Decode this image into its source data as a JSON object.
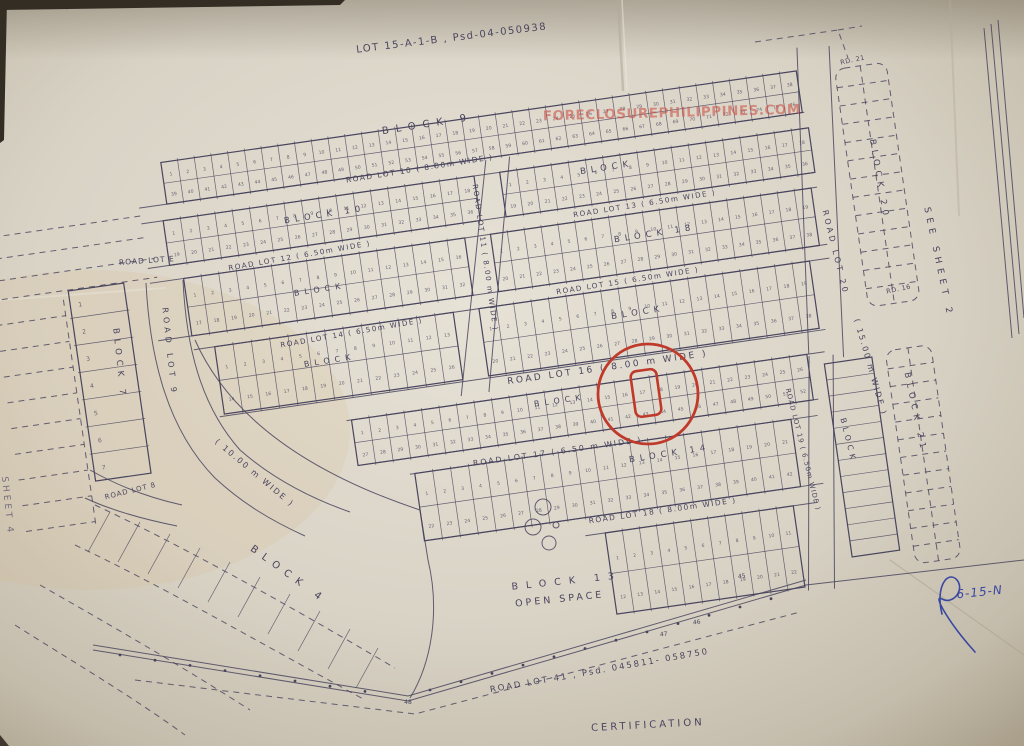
{
  "photo": {
    "description": "photographed blueprint subdivision survey plan",
    "watermark": "FORECLOSUREPHILIPPINES.COM",
    "handwritten_note": "6-15-N"
  },
  "colors": {
    "paper": "#d9d3c6",
    "paper_edge": "#8f8676",
    "ink": "#49455e",
    "highlight_red": "#bf3a2b",
    "pen_blue": "#3947a3",
    "watermark_red": "#cb5448"
  },
  "labels": [
    {
      "id": "top-contractor",
      "t": "GW / CONTRACTOR",
      "x": 112,
      "y": 6,
      "r": -4,
      "s": 8.5,
      "sp": 1,
      "c": "ink-faint"
    },
    {
      "id": "top-developer",
      "t": "DEVELOPER",
      "x": 268,
      "y": 4,
      "r": -3,
      "s": 8.5,
      "sp": 1.5,
      "c": "ink-faint"
    },
    {
      "id": "plan-title",
      "t": "LOT 15-A-1-B , Psd-04-050938",
      "x": 452,
      "y": 41,
      "r": -7,
      "s": 10,
      "sp": 1.5,
      "c": "ink"
    },
    {
      "id": "watermark",
      "t": "FORECLOSUREPHILIPPINES.COM",
      "x": 672,
      "y": 117,
      "r": -1.5,
      "s": 13.5,
      "sp": 0.5,
      "c": "wm"
    },
    {
      "id": "block-9",
      "t": "BLOCK 9",
      "x": 428,
      "y": 127,
      "r": -9,
      "s": 10,
      "sp": 7,
      "c": "ink"
    },
    {
      "id": "road-lot-10",
      "t": "ROAD LOT 10 ( 8.00m WIDE )",
      "x": 420,
      "y": 171,
      "r": -9,
      "s": 7.5,
      "sp": 1.5,
      "c": "ink"
    },
    {
      "id": "block-b-right",
      "t": "BLOCK",
      "x": 607,
      "y": 170,
      "r": -9,
      "s": 8.5,
      "sp": 5,
      "c": "ink"
    },
    {
      "id": "road-lot-13",
      "t": "ROAD LOT 13 ( 6.50m WIDE )",
      "x": 645,
      "y": 206,
      "r": -9,
      "s": 7.2,
      "sp": 1.5,
      "c": "ink"
    },
    {
      "id": "block-10",
      "t": "BLOCK 10",
      "x": 325,
      "y": 217,
      "r": -9,
      "s": 8.5,
      "sp": 5,
      "c": "ink"
    },
    {
      "id": "road-lot-12",
      "t": "ROAD LOT 12 ( 6.50m WIDE )",
      "x": 300,
      "y": 258,
      "r": -10,
      "s": 7.2,
      "sp": 1.5,
      "c": "ink"
    },
    {
      "id": "block-18",
      "t": "BLOCK 18",
      "x": 655,
      "y": 236,
      "r": -9,
      "s": 8.5,
      "sp": 5,
      "c": "ink"
    },
    {
      "id": "road-lot-15",
      "t": "ROAD LOT 15 ( 6.50m WIDE )",
      "x": 628,
      "y": 283,
      "r": -9,
      "s": 7.2,
      "sp": 1.5,
      "c": "ink"
    },
    {
      "id": "road-lot-14",
      "t": "ROAD LOT 14 ( 6.50m WIDE )",
      "x": 352,
      "y": 335,
      "r": -10,
      "s": 7.2,
      "sp": 1.5,
      "c": "ink"
    },
    {
      "id": "block-c-left",
      "t": "BLOCK",
      "x": 320,
      "y": 292,
      "r": -9,
      "s": 8,
      "sp": 5,
      "c": "ink"
    },
    {
      "id": "block-d-left",
      "t": "BLOCK",
      "x": 330,
      "y": 363,
      "r": -9,
      "s": 8,
      "sp": 5,
      "c": "ink"
    },
    {
      "id": "block-d-right",
      "t": "BLOCK",
      "x": 638,
      "y": 315,
      "r": -9,
      "s": 8.5,
      "sp": 5,
      "c": "ink"
    },
    {
      "id": "road-lot-11",
      "t": "ROAD LOT 11 ( 8.00 m WIDE )",
      "x": 483,
      "y": 258,
      "r": 82,
      "s": 7.2,
      "sp": 1.5,
      "c": "ink"
    },
    {
      "id": "road-lot-16",
      "t": "ROAD LOT 16 ( 8.00 m WIDE )",
      "x": 608,
      "y": 370,
      "r": -8,
      "s": 9,
      "sp": 2.5,
      "c": "ink"
    },
    {
      "id": "block-e",
      "t": "BLOCK",
      "x": 560,
      "y": 403,
      "r": -8,
      "s": 8,
      "sp": 5,
      "c": "ink"
    },
    {
      "id": "road-lot-17",
      "t": "ROAD LOT 17 ( 6.50 m WIDE )",
      "x": 558,
      "y": 454,
      "r": -8,
      "s": 7.8,
      "sp": 2,
      "c": "ink"
    },
    {
      "id": "block-14",
      "t": "BLOCK 14",
      "x": 670,
      "y": 456,
      "r": -9,
      "s": 8.5,
      "sp": 5,
      "c": "ink"
    },
    {
      "id": "road-lot-18",
      "t": "ROAD LOT 18 ( 8.00m WIDE )",
      "x": 663,
      "y": 513,
      "r": -8,
      "s": 7.5,
      "sp": 1.5,
      "c": "ink"
    },
    {
      "id": "block-13",
      "t": "BLOCK 13",
      "x": 567,
      "y": 584,
      "r": -6,
      "s": 9.5,
      "sp": 8,
      "c": "ink"
    },
    {
      "id": "open-space",
      "t": "OPEN SPACE",
      "x": 560,
      "y": 602,
      "r": -6,
      "s": 9.5,
      "sp": 3,
      "c": "ink"
    },
    {
      "id": "road-lot-9",
      "t": "ROAD LOT 9",
      "x": 167,
      "y": 352,
      "r": 84,
      "s": 8,
      "sp": 4,
      "c": "ink"
    },
    {
      "id": "road-lot-9-width",
      "t": "( 10.00 m WIDE )",
      "x": 253,
      "y": 475,
      "r": 40,
      "s": 8,
      "sp": 2,
      "c": "ink"
    },
    {
      "id": "road-lot-8",
      "t": "ROAD LOT 8",
      "x": 131,
      "y": 493,
      "r": -14,
      "s": 7,
      "sp": 1,
      "c": "ink"
    },
    {
      "id": "road-lot-e",
      "t": "ROAD LOT E",
      "x": 147,
      "y": 263,
      "r": -4,
      "s": 7.5,
      "sp": 1,
      "c": "ink"
    },
    {
      "id": "block-7",
      "t": "BLOCK 7",
      "x": 117,
      "y": 364,
      "r": 84,
      "s": 8.5,
      "sp": 5,
      "c": "ink"
    },
    {
      "id": "block-4",
      "t": "BLOCK 4",
      "x": 287,
      "y": 577,
      "r": 36,
      "s": 10,
      "sp": 7,
      "c": "ink"
    },
    {
      "id": "sheet-4",
      "t": "SHEET 4",
      "x": 5,
      "y": 506,
      "r": 84,
      "s": 9,
      "sp": 3,
      "c": "ink-faint"
    },
    {
      "id": "rd-21",
      "t": "RD. 21",
      "x": 853,
      "y": 62,
      "r": -12,
      "s": 6.5,
      "sp": 0.5,
      "c": "ink"
    },
    {
      "id": "block-20",
      "t": "BLOCK 20",
      "x": 877,
      "y": 180,
      "r": 80,
      "s": 8.5,
      "sp": 5,
      "c": "ink"
    },
    {
      "id": "rd-16",
      "t": "RD. 16",
      "x": 899,
      "y": 291,
      "r": -12,
      "s": 6.5,
      "sp": 0.5,
      "c": "ink"
    },
    {
      "id": "road-lot-20",
      "t": "ROAD LOT 20",
      "x": 833,
      "y": 253,
      "r": 76,
      "s": 8,
      "sp": 3,
      "c": "ink"
    },
    {
      "id": "road-lot-20-width",
      "t": "( 15.00 m WIDE )",
      "x": 868,
      "y": 368,
      "r": 74,
      "s": 8,
      "sp": 2,
      "c": "ink"
    },
    {
      "id": "see-sheet-2",
      "t": "SEE SHEET 2",
      "x": 936,
      "y": 263,
      "r": 78,
      "s": 9,
      "sp": 5,
      "c": "ink"
    },
    {
      "id": "block-21",
      "t": "BLOCK 21",
      "x": 913,
      "y": 413,
      "r": 78,
      "s": 8.5,
      "sp": 5,
      "c": "ink"
    },
    {
      "id": "road-lot-19",
      "t": "ROAD LOT 19 ( 6.50m WIDE )",
      "x": 801,
      "y": 450,
      "r": 76,
      "s": 6.8,
      "sp": 1,
      "c": "ink"
    },
    {
      "id": "block-h",
      "t": "BLOCK",
      "x": 846,
      "y": 441,
      "r": 76,
      "s": 7.8,
      "sp": 4,
      "c": "ink"
    },
    {
      "id": "road-lot-41",
      "t": "ROAD LOT 41 , Psd. 045811- 058750",
      "x": 600,
      "y": 673,
      "r": -10,
      "s": 8.5,
      "sp": 2,
      "c": "ink"
    },
    {
      "id": "certification",
      "t": "CERTIFICATION",
      "x": 648,
      "y": 728,
      "r": -3,
      "s": 10,
      "sp": 3,
      "c": "ink"
    },
    {
      "id": "handwritten-note",
      "t": "6-15-N",
      "x": 980,
      "y": 596,
      "r": -6,
      "s": 12,
      "sp": 1,
      "c": "pen"
    },
    {
      "id": "pt-45",
      "t": "45",
      "x": 742,
      "y": 578,
      "r": -8,
      "s": 6,
      "sp": 0,
      "c": "ink"
    },
    {
      "id": "pt-46",
      "t": "46",
      "x": 697,
      "y": 624,
      "r": -8,
      "s": 6,
      "sp": 0,
      "c": "ink"
    },
    {
      "id": "pt-47",
      "t": "47",
      "x": 664,
      "y": 636,
      "r": -8,
      "s": 6,
      "sp": 0,
      "c": "ink"
    },
    {
      "id": "pt-48",
      "t": "48",
      "x": 408,
      "y": 704,
      "r": 0,
      "s": 6,
      "sp": 0,
      "c": "ink"
    }
  ],
  "geometry": {
    "rotation_deg": -8.2,
    "rotation_center": [
      480,
      260
    ],
    "bands": [
      {
        "id": "band-block9",
        "x1": 178,
        "y1": 118,
        "x2": 820,
        "y2": 160,
        "count": 38,
        "rows": 2
      },
      {
        "id": "band-b-left",
        "x1": 172,
        "y1": 176,
        "x2": 486,
        "y2": 221,
        "count": 18,
        "rows": 2
      },
      {
        "id": "band-b-right",
        "x1": 512,
        "y1": 176,
        "x2": 824,
        "y2": 221,
        "count": 18,
        "rows": 2
      },
      {
        "id": "band-c-left",
        "x1": 184,
        "y1": 236,
        "x2": 468,
        "y2": 294,
        "count": 16,
        "rows": 2
      },
      {
        "id": "band-c-right",
        "x1": 494,
        "y1": 236,
        "x2": 818,
        "y2": 294,
        "count": 19,
        "rows": 2
      },
      {
        "id": "band-d-left",
        "x1": 205,
        "y1": 308,
        "x2": 446,
        "y2": 376,
        "count": 13,
        "rows": 2
      },
      {
        "id": "band-d-right",
        "x1": 472,
        "y1": 308,
        "x2": 806,
        "y2": 376,
        "count": 19,
        "rows": 2
      },
      {
        "id": "band-e-circle",
        "x1": 330,
        "y1": 400,
        "x2": 790,
        "y2": 446,
        "count": 26,
        "rows": 2
      },
      {
        "id": "band-block14",
        "x1": 385,
        "y1": 462,
        "x2": 765,
        "y2": 530,
        "count": 21,
        "rows": 2
      },
      {
        "id": "band-block13",
        "x1": 565,
        "y1": 548,
        "x2": 755,
        "y2": 630,
        "count": 11,
        "rows": 2
      }
    ],
    "vband_block7": {
      "x1": 68,
      "y1": 232,
      "x2": 124,
      "y2": 424,
      "cells": 7
    },
    "band_h": {
      "x1": 806,
      "y1": 412,
      "x2": 854,
      "y2": 607,
      "rungs": 12
    },
    "dashed_blocks": [
      {
        "id": "block-20-grid",
        "x1": 858,
        "y1": 122,
        "x2": 910,
        "y2": 362,
        "rungs": 13
      },
      {
        "id": "block-21-grid",
        "x1": 868,
        "y1": 408,
        "x2": 914,
        "y2": 623,
        "rungs": 12
      }
    ],
    "road_lines": [
      [
        150,
        160,
        822,
        160
      ],
      [
        150,
        176,
        822,
        176
      ],
      [
        150,
        221,
        824,
        221
      ],
      [
        150,
        236,
        824,
        236
      ],
      [
        150,
        294,
        826,
        294
      ],
      [
        184,
        308,
        826,
        308
      ],
      [
        200,
        378,
        812,
        378
      ],
      [
        325,
        400,
        808,
        400
      ],
      [
        330,
        446,
        795,
        446
      ],
      [
        380,
        462,
        792,
        462
      ],
      [
        388,
        530,
        788,
        530
      ],
      [
        545,
        548,
        780,
        548
      ],
      [
        500,
        162,
        442,
        392
      ],
      [
        524,
        162,
        470,
        392
      ],
      [
        824,
        95,
        792,
        400
      ],
      [
        856,
        98,
        826,
        408
      ],
      [
        792,
        402,
        758,
        634
      ],
      [
        816,
        404,
        784,
        636
      ]
    ],
    "left_margin_dash_rows": [
      256,
      282,
      308,
      334,
      360,
      386,
      412,
      438,
      464
    ],
    "boundary_dots_a": {
      "x0": 430,
      "y0": 690,
      "dx": 31,
      "dy": -8.3,
      "n": 12
    },
    "boundary_dots_b": {
      "x0": 120,
      "y0": 655,
      "dx": 35,
      "dy": 5.2,
      "n": 8
    }
  },
  "highlight": {
    "circle": {
      "cx": 648,
      "cy": 394,
      "r": 50
    },
    "lot_box": {
      "x": 633,
      "y": 370,
      "w": 26,
      "h": 46
    }
  }
}
